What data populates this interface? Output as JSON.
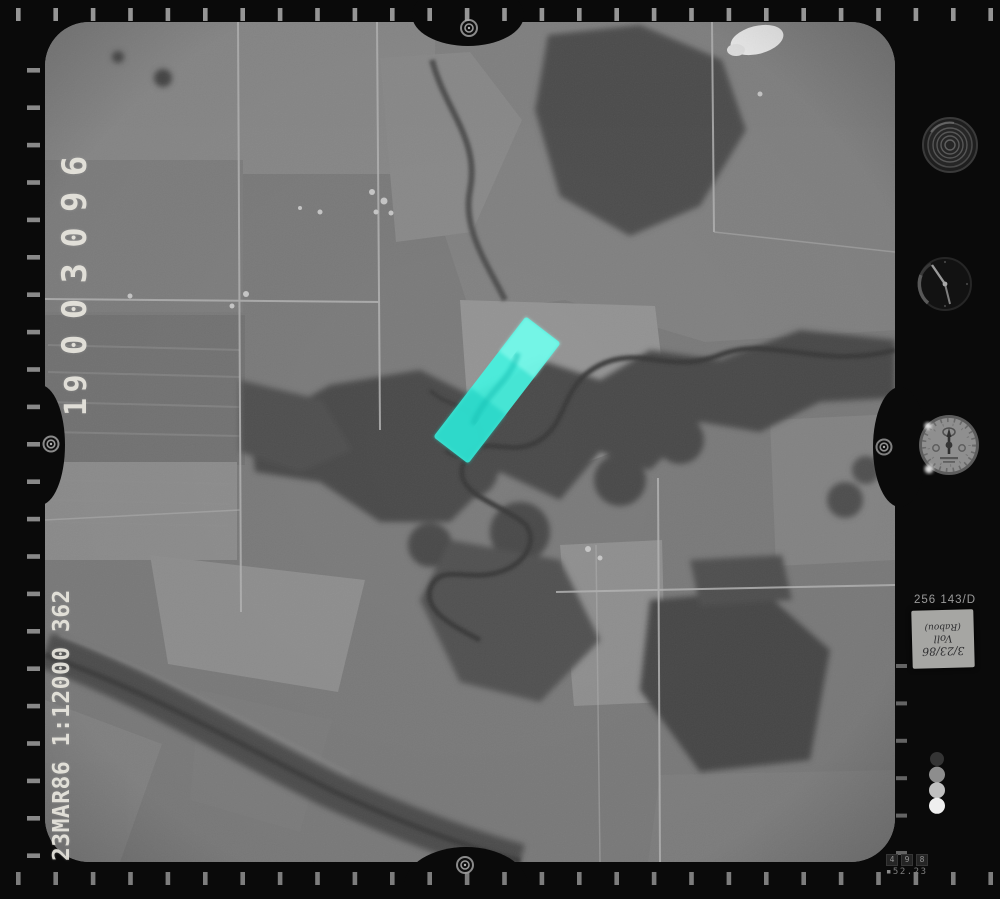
{
  "meta": {
    "description": "Black-and-white aerial survey photograph film frame, scanned with film edge instrumentation",
    "highlight_note": "cyan strip overlay on photo center"
  },
  "colors": {
    "highlight": "#45f2e0",
    "highlight_dark": "#1fd0c2",
    "highlight_light": "#9cfff2",
    "film_black": "#0a0a0a"
  },
  "annotations": {
    "frame_prefix": "19",
    "frame_number": "003096",
    "flight_info": "23MAR86 1:12000 362"
  },
  "data_strip": {
    "printed_label": "256 143/D",
    "handwritten": [
      "3/23/86",
      "Voll",
      "(Rabou)"
    ]
  },
  "counter": {
    "cells": [
      "4",
      "9",
      "8"
    ],
    "reading": "52.23"
  },
  "instruments": {
    "top": "level-dial",
    "middle": "clock-dial",
    "bottom": "altimeter-dial"
  },
  "step_wedge": [
    "#343434",
    "#8d8d8d",
    "#c0c0c0",
    "#efefef"
  ]
}
